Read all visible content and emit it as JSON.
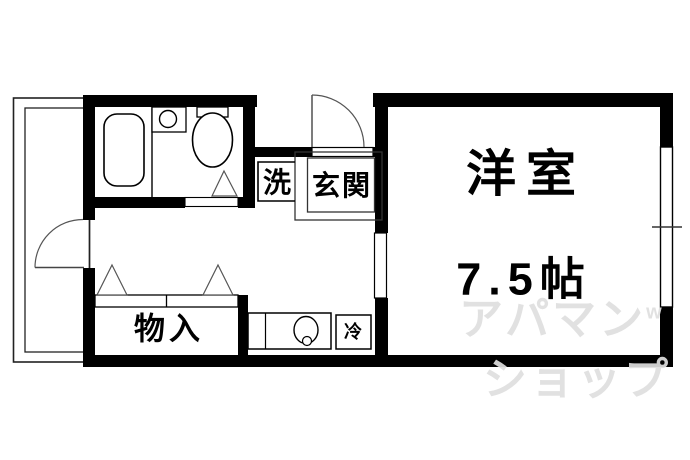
{
  "plan": {
    "labels": {
      "western_room": "洋室",
      "western_room_size": "7.5帖",
      "entrance": "玄関",
      "washer": "洗",
      "storage": "物入",
      "fridge": "冷"
    },
    "watermark": {
      "line1": "アパマン",
      "line1_sup": "w",
      "line2": "ショップ"
    },
    "colors": {
      "wall": "#000000",
      "background": "#ffffff",
      "thin_line": "#333333",
      "watermark": "#dedede"
    }
  }
}
